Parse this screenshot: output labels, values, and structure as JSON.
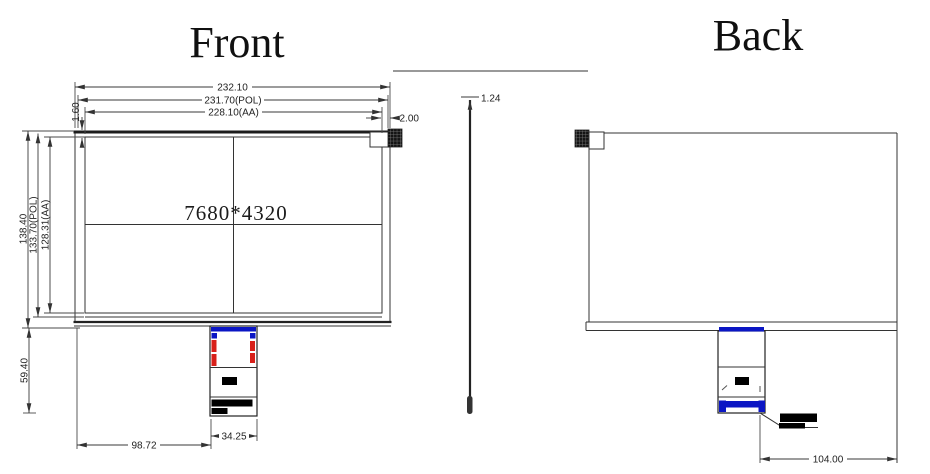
{
  "titles": {
    "front": "Front",
    "back": "Back"
  },
  "front_view": {
    "resolution_label": "7680*4320",
    "dims": {
      "outline_width": "232.10",
      "pol_width": "231.70(POL)",
      "active_area_width": "228.10(AA)",
      "right_edge_gap": "2.00",
      "top_edge_gap": "1.60",
      "active_area_height": "128.31(AA)",
      "pol_height": "133.70(POL)",
      "outline_height": "138.40",
      "fpc_drop_height": "59.40",
      "fpc_offset_from_left": "98.72",
      "fpc_width": "34.25"
    }
  },
  "side_view": {
    "dims": {
      "thickness": "1.24"
    }
  },
  "back_view": {
    "dims": {
      "fpc_to_right_edge": "104.00"
    }
  },
  "colors": {
    "drawing_line": "#333333",
    "fpc_tape_blue": "#0b16c4",
    "fpc_mark_red": "#d8201a",
    "label_block_black": "#000000"
  }
}
